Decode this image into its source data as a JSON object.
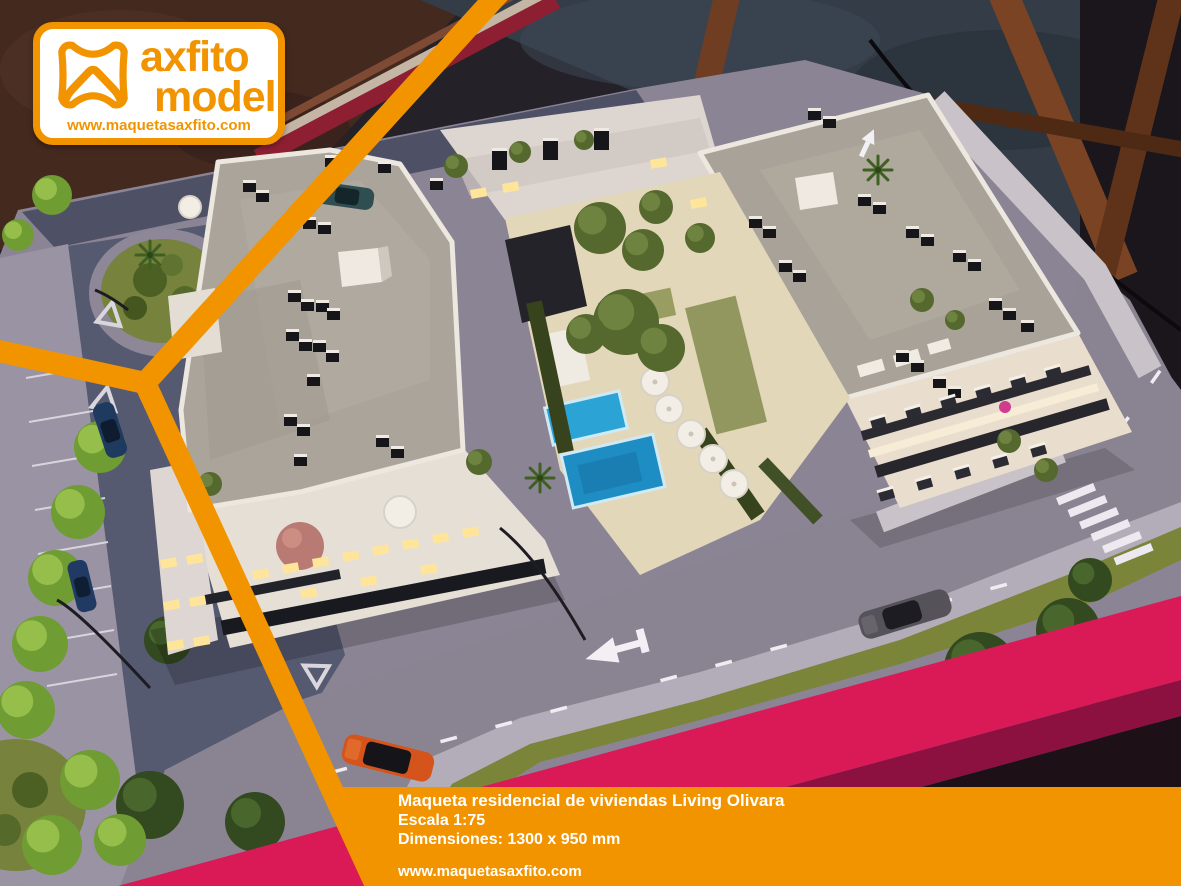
{
  "brand": {
    "name_line1": "axfito",
    "name_line2": "model",
    "website": "www.maquetasaxfito.com"
  },
  "caption": {
    "title": "Maqueta residencial de viviendas Living Olivara",
    "scale": "Escala 1:75",
    "dimensions": "Dimensiones: 1300 x 950 mm",
    "website": "www.maquetasaxfito.com"
  },
  "colors": {
    "accent_orange": "#F29400",
    "magenta_base_edge": "#D91A57",
    "pool_blue": "#2BA3D4",
    "caption_text": "#FFFFFF"
  }
}
